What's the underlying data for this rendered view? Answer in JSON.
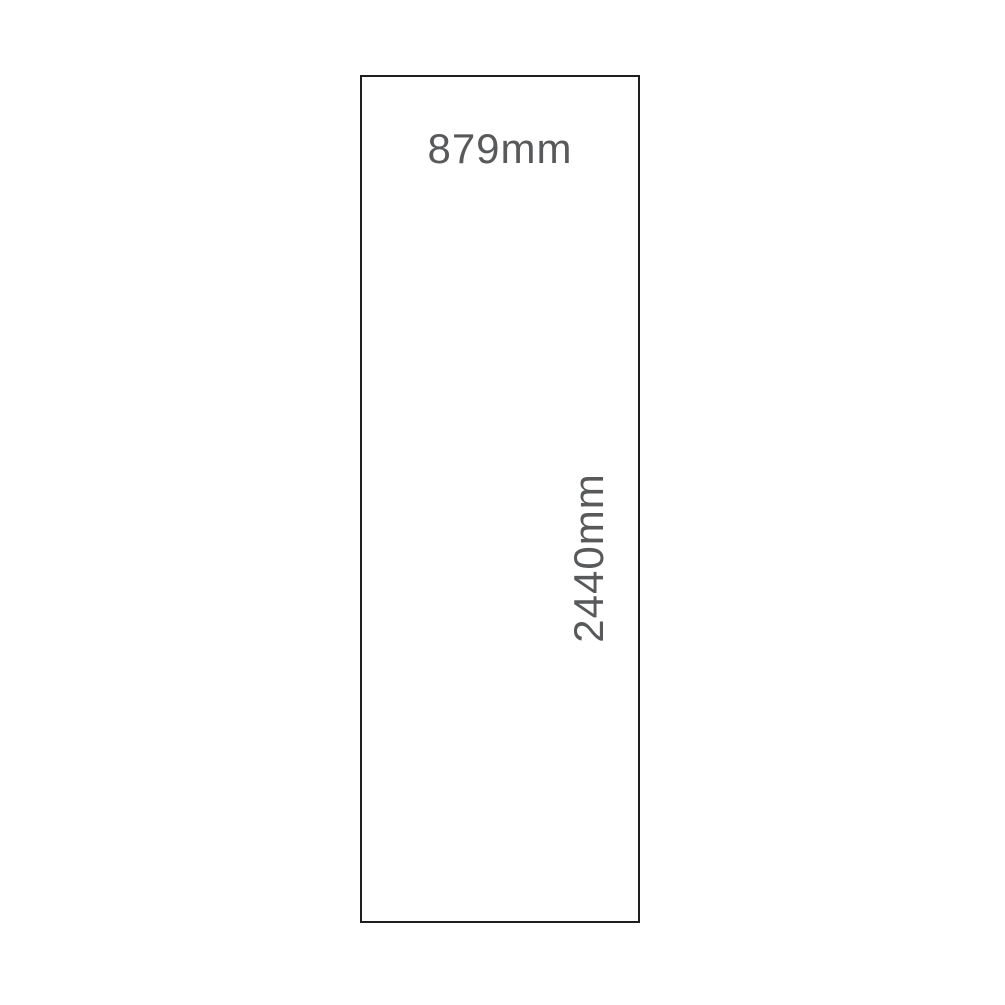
{
  "diagram": {
    "panel": {
      "width_label": "879mm",
      "height_label": "2440mm"
    },
    "colors": {
      "background": "#ffffff",
      "outline": "#1e1e1e",
      "label_text": "#58595b"
    }
  }
}
